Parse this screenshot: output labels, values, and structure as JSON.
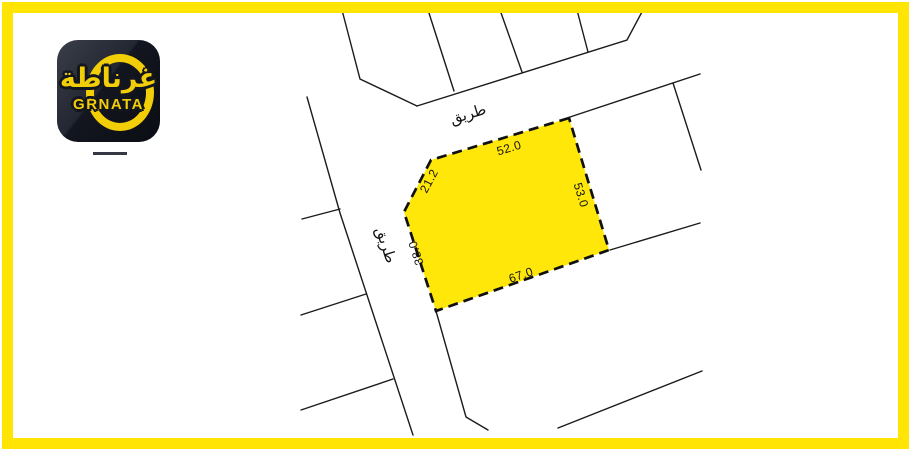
{
  "brand": {
    "logo_arabic": "غرناطة",
    "logo_latin": "GRNATA"
  },
  "colors": {
    "frame_yellow": "#FFE404",
    "plot_fill_yellow": "#FFE70A",
    "logo_yellow": "#F2CE08",
    "logo_background": "#14161e",
    "map_line_black": "#1b1b1b"
  },
  "map": {
    "road_labels": {
      "top": "طريق",
      "left": "طريق"
    },
    "plot": {
      "dimensions": {
        "top": "52.0",
        "northwest": "21.2",
        "west": "38.0",
        "south": "67.0",
        "east": "53.0"
      }
    }
  }
}
